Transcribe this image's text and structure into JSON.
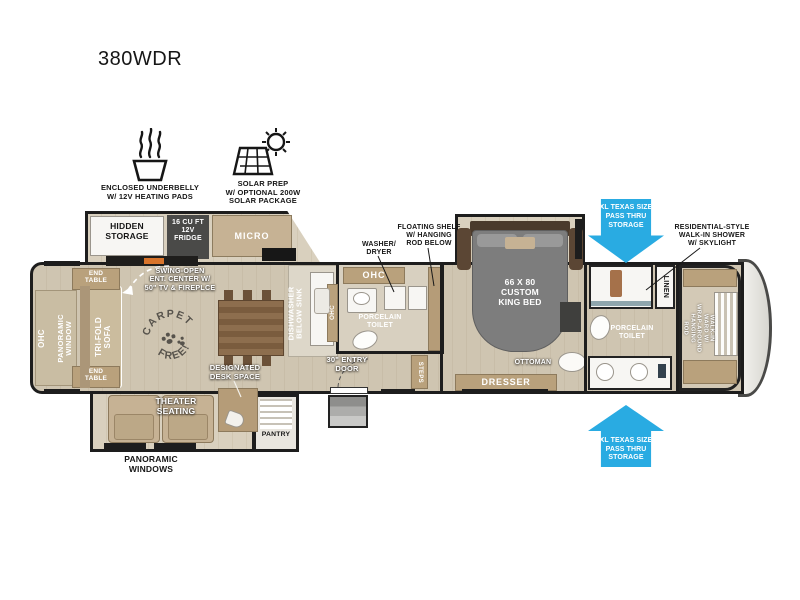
{
  "title": "380WDR",
  "colors": {
    "accent_blue": "#29ABE2",
    "wall": "#1D1D1D",
    "floor_beige": "#CFC5B1",
    "cabinet_tan": "#B9A17C",
    "appliance_dark": "#4A4A48",
    "bed_gray": "#7D7D7D"
  },
  "features": {
    "underbelly": {
      "icon": "heating-waves-icon",
      "label": "ENCLOSED UNDERBELLY\nW/ 12V HEATING PADS"
    },
    "solar": {
      "icon": "solar-panel-sun-icon",
      "label": "SOLAR PREP\nW/ OPTIONAL 200W\nSOLAR PACKAGE"
    }
  },
  "plan": {
    "kitchen": {
      "hidden_storage": "HIDDEN\nSTORAGE",
      "fridge": "16 CU FT\n12V\nFRIDGE",
      "micro": "MICRO",
      "swing_open": "SWING-OPEN\nENT. CENTER W/\n50\" TV & FIREPLCE",
      "dishwasher": "DISHWASHER\nBELOW SINK",
      "ohc": "OHC"
    },
    "living": {
      "ohc": "OHC",
      "panoramic_window": "PANORAMIC\nWINDOW",
      "trifold_sofa": "TRI-FOLD\nSOFA",
      "end_table_top": "END\nTABLE",
      "end_table_bottom": "END\nTABLE",
      "carpet_top": "CARPET",
      "carpet_bottom": "FREE!",
      "designated_desk": "DESIGNATED\nDESK SPACE",
      "theater_seating": "THEATER\nSEATING",
      "panoramic_windows": "PANORAMIC\nWINDOWS",
      "pantry": "PANTRY"
    },
    "mid_bath": {
      "ohc": "OHC",
      "washer_dryer": "WASHER/\nDRYER",
      "floating_shelf": "FLOATING SHELF\nW/ HANGING\nROD BELOW",
      "toilet": "PORCELAIN\nTOILET"
    },
    "entry": {
      "door": "30\" ENTRY\nDOOR",
      "steps": "STEPS"
    },
    "bedroom": {
      "bed": "66 X 80\nCUSTOM\nKING BED",
      "ottoman": "OTTOMAN",
      "dresser": "DRESSER"
    },
    "front_bath": {
      "shower": "RESIDENTIAL-STYLE\nWALK-IN SHOWER\nW/ SKYLIGHT",
      "toilet": "PORCELAIN\nTOILET",
      "linen": "LINEN"
    },
    "wardrobe": {
      "walkin": "WALK-IN\nWARD W/\nWRAP-AROUND\nHANGING\nROD"
    },
    "storage_arrows": {
      "top": "XL TEXAS SIZE\nPASS THRU\nSTORAGE",
      "bottom": "XL TEXAS SIZE\nPASS THRU\nSTORAGE"
    }
  }
}
